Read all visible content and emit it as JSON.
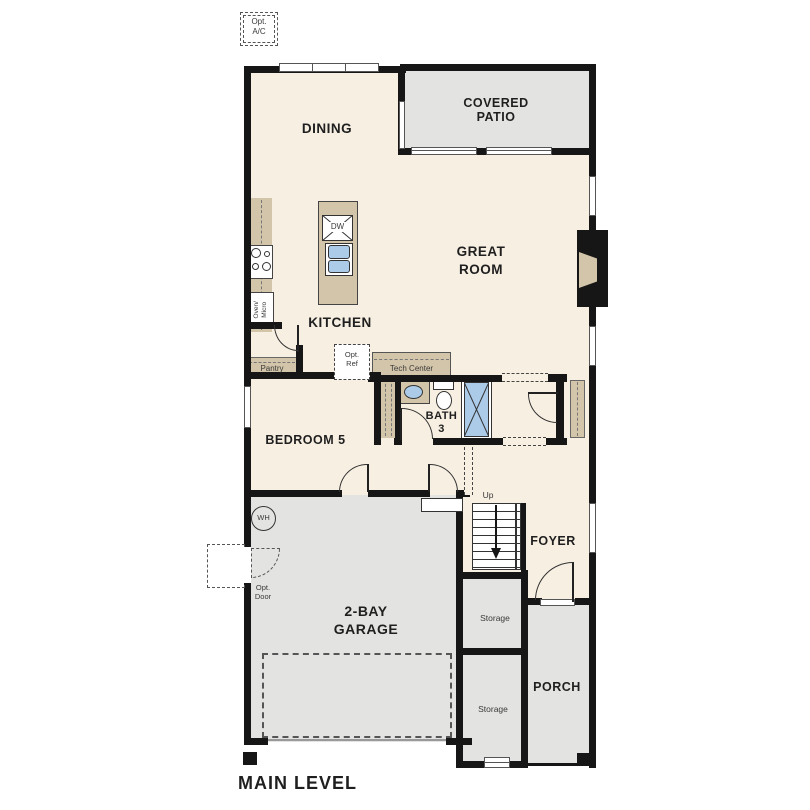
{
  "plan_title": "MAIN LEVEL",
  "colors": {
    "wall": "#161616",
    "room": "#f7efe2",
    "outdoor": "#e3e3e1",
    "counter": "#d3c5a9",
    "fixture": "#accbe9",
    "label": "#1f1f1f",
    "small": "#3a3a3a"
  },
  "rooms": {
    "dining": "DINING",
    "covered_patio": [
      "COVERED",
      "PATIO"
    ],
    "great_room": [
      "GREAT",
      "ROOM"
    ],
    "kitchen": "KITCHEN",
    "bedroom5": "BEDROOM 5",
    "bath3": [
      "BATH",
      "3"
    ],
    "foyer": "FOYER",
    "garage": [
      "2-BAY",
      "GARAGE"
    ],
    "porch": "PORCH",
    "storage_upper": "Storage",
    "storage_lower": "Storage"
  },
  "features": {
    "opt_ac": [
      "Opt.",
      "A/C"
    ],
    "dishwasher": "DW",
    "oven_micro": [
      "Oven/",
      "Micro"
    ],
    "pantry": "Pantry",
    "opt_ref": [
      "Opt.",
      "Ref"
    ],
    "tech_center": "Tech Center",
    "up": "Up",
    "water_heater": "WH",
    "opt_door": [
      "Opt.",
      "Door"
    ]
  }
}
